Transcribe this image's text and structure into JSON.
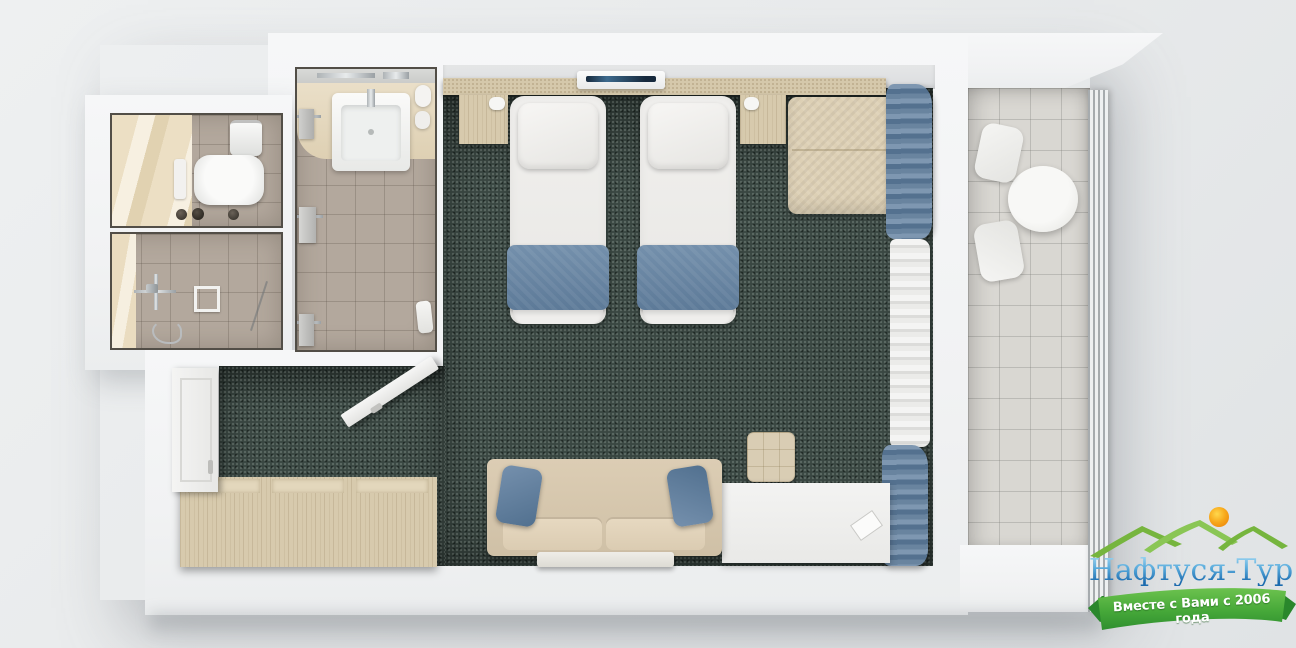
{
  "scene": {
    "description": "Top-down 3D render of a hotel twin-room floor plan",
    "rooms": [
      "bedroom",
      "bathroom",
      "shower-room",
      "wc",
      "entry-hall",
      "balcony"
    ],
    "furniture": [
      "twin-bed-left",
      "twin-bed-right",
      "nightstand-left",
      "nightstand-right",
      "air-conditioner",
      "headboard",
      "armchair",
      "sofa",
      "coffee-table",
      "ottoman",
      "desk",
      "wardrobe",
      "entry-door",
      "bathroom-door",
      "washbasin",
      "toilet",
      "shower-fixture",
      "floor-drain",
      "towel-rails",
      "balcony-table",
      "balcony-chair-upper",
      "balcony-chair-lower",
      "balcony-railing",
      "curtain-blue-upper",
      "curtain-sheer",
      "curtain-blue-lower"
    ]
  },
  "logo": {
    "brand": "Нафтуся-Тур",
    "tagline": "Вместе с Вами с 2006 года",
    "colors": {
      "brand_text": "#2f7fc1",
      "mountains": "#7cb942",
      "sun": "#f6a41c",
      "ribbon": "#3f9c35",
      "ribbon_text": "#ffffff"
    }
  },
  "palette": {
    "background": "#e9ebec",
    "walls": "#f3f4f5",
    "carpet": "#3a4742",
    "bathroom_tile": "#b3a89d",
    "balcony_tile": "#d9d7d2",
    "wood": "#d7caad",
    "bed_linen": "#f0efed",
    "accent_blue": "#64809e",
    "sofa_beige": "#d9cbb2"
  }
}
